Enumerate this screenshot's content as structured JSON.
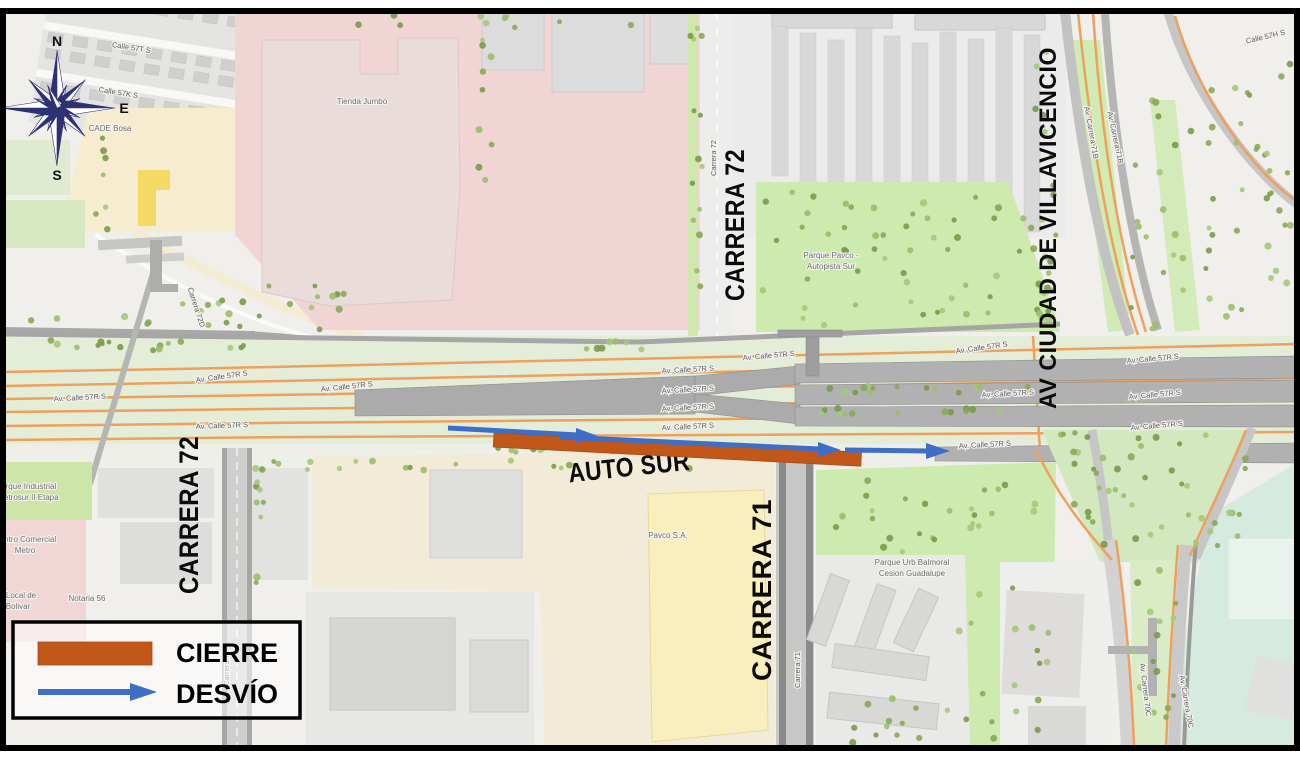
{
  "colors": {
    "closure": "#c2571a",
    "detour": "#3e6ec5",
    "frame": "#000000"
  },
  "compass": {
    "n": "N",
    "e": "E",
    "s": "S"
  },
  "legend": {
    "cierre": "CIERRE",
    "desvio": "DESVÍO"
  },
  "big_labels": {
    "auto_sur": "AUTO SUR",
    "carrera_72_top": "CARRERA 72",
    "carrera_72_left": "CARRERA 72",
    "carrera_71": "CARRERA 71",
    "villavicencio": "AV CIUDAD DE VILLAVICENCIO"
  },
  "street_labels": [
    {
      "t": "Calle 57T S",
      "x": 131,
      "y": 50,
      "r": 9
    },
    {
      "t": "Calle 57K S",
      "x": 118,
      "y": 95,
      "r": 9
    },
    {
      "t": "Carrera 72",
      "x": 716,
      "y": 158,
      "r": -90,
      "s": 7
    },
    {
      "t": "Carrera 72D",
      "x": 194,
      "y": 308,
      "r": 72,
      "s": 7
    },
    {
      "t": "Calle 57H S",
      "x": 1266,
      "y": 39,
      "r": -13
    },
    {
      "t": "Av. Carrera 71B",
      "x": 1089,
      "y": 133,
      "r": 80,
      "s": 7
    },
    {
      "t": "Av. Carrera 71B",
      "x": 1113,
      "y": 138,
      "r": 78,
      "s": 7
    },
    {
      "t": "Av. Calle 57R S",
      "x": 80,
      "y": 400,
      "r": -3
    },
    {
      "t": "Av. Calle 57R S",
      "x": 222,
      "y": 379,
      "r": -8
    },
    {
      "t": "Av. Calle 57R S",
      "x": 347,
      "y": 389,
      "r": -6
    },
    {
      "t": "Av. Calle 57R S",
      "x": 222,
      "y": 428,
      "r": -2
    },
    {
      "t": "Av. Calle 57R S",
      "x": 769,
      "y": 358,
      "r": -5
    },
    {
      "t": "Av. Calle 57R S",
      "x": 688,
      "y": 372,
      "r": -3
    },
    {
      "t": "Av. Calle 57R S",
      "x": 688,
      "y": 392,
      "r": -3
    },
    {
      "t": "Av. Calle 57R S",
      "x": 688,
      "y": 410,
      "r": -3
    },
    {
      "t": "Av. Calle 57R S",
      "x": 688,
      "y": 429,
      "r": -3
    },
    {
      "t": "Av. Calle 57R S",
      "x": 982,
      "y": 350,
      "r": -8
    },
    {
      "t": "Av. Calle 57R S",
      "x": 1008,
      "y": 396,
      "r": -3
    },
    {
      "t": "Av. Calle 57R S",
      "x": 985,
      "y": 447,
      "r": -3
    },
    {
      "t": "Av. Calle 57R S",
      "x": 1153,
      "y": 361,
      "r": -5
    },
    {
      "t": "Av. Calle 57R S",
      "x": 1155,
      "y": 397,
      "r": -5
    },
    {
      "t": "Av. Calle 57R S",
      "x": 1157,
      "y": 428,
      "r": -5
    },
    {
      "t": "Carrera 71",
      "x": 800,
      "y": 670,
      "r": -90,
      "s": 7
    },
    {
      "t": "Carrera 72",
      "x": 229,
      "y": 668,
      "r": -90,
      "s": 7
    },
    {
      "t": "Av. Carrera 70C",
      "x": 1143,
      "y": 690,
      "r": 83,
      "s": 7
    },
    {
      "t": "Av. Carrera 70C",
      "x": 1184,
      "y": 702,
      "r": 80,
      "s": 7
    }
  ],
  "place_labels": [
    {
      "t": "Tienda Jumbo",
      "x": 362,
      "y": 104,
      "s": 11,
      "c": "#666666"
    },
    {
      "t": "CADE Bosa",
      "x": 110,
      "y": 131,
      "s": 8,
      "c": "#5a5a5a"
    },
    {
      "t": "Parque Pavco -",
      "x": 831,
      "y": 258,
      "s": 8,
      "c": "#7e8e6a"
    },
    {
      "t": "Autopista Sur",
      "x": 831,
      "y": 269,
      "s": 8,
      "c": "#7e8e6a"
    },
    {
      "t": "Parque Urb Balmoral",
      "x": 912,
      "y": 565,
      "s": 7.5,
      "c": "#7e8e6a"
    },
    {
      "t": "Cesion Guadalupe",
      "x": 912,
      "y": 576,
      "s": 7.5,
      "c": "#7e8e6a"
    },
    {
      "t": "Parque Industrial",
      "x": 26,
      "y": 489,
      "s": 8,
      "c": "#728259"
    },
    {
      "t": "Metrosur II Etapa",
      "x": 28,
      "y": 500,
      "s": 8,
      "c": "#728259"
    },
    {
      "t": "Centro Comercial",
      "x": 25,
      "y": 542,
      "s": 8,
      "c": "#6d6d6d"
    },
    {
      "t": "Metro",
      "x": 25,
      "y": 553,
      "s": 8,
      "c": "#6d6d6d"
    },
    {
      "t": "Local de",
      "x": 21,
      "y": 598,
      "s": 8,
      "c": "#6d6d6d"
    },
    {
      "t": "Bolivar",
      "x": 18,
      "y": 609,
      "s": 8,
      "c": "#6d6d6d"
    },
    {
      "t": "Notaria 56",
      "x": 87,
      "y": 601,
      "s": 8,
      "c": "#6d6d6d"
    },
    {
      "t": "Pavco S.A.",
      "x": 668,
      "y": 538,
      "s": 9,
      "c": "#82826d"
    }
  ]
}
